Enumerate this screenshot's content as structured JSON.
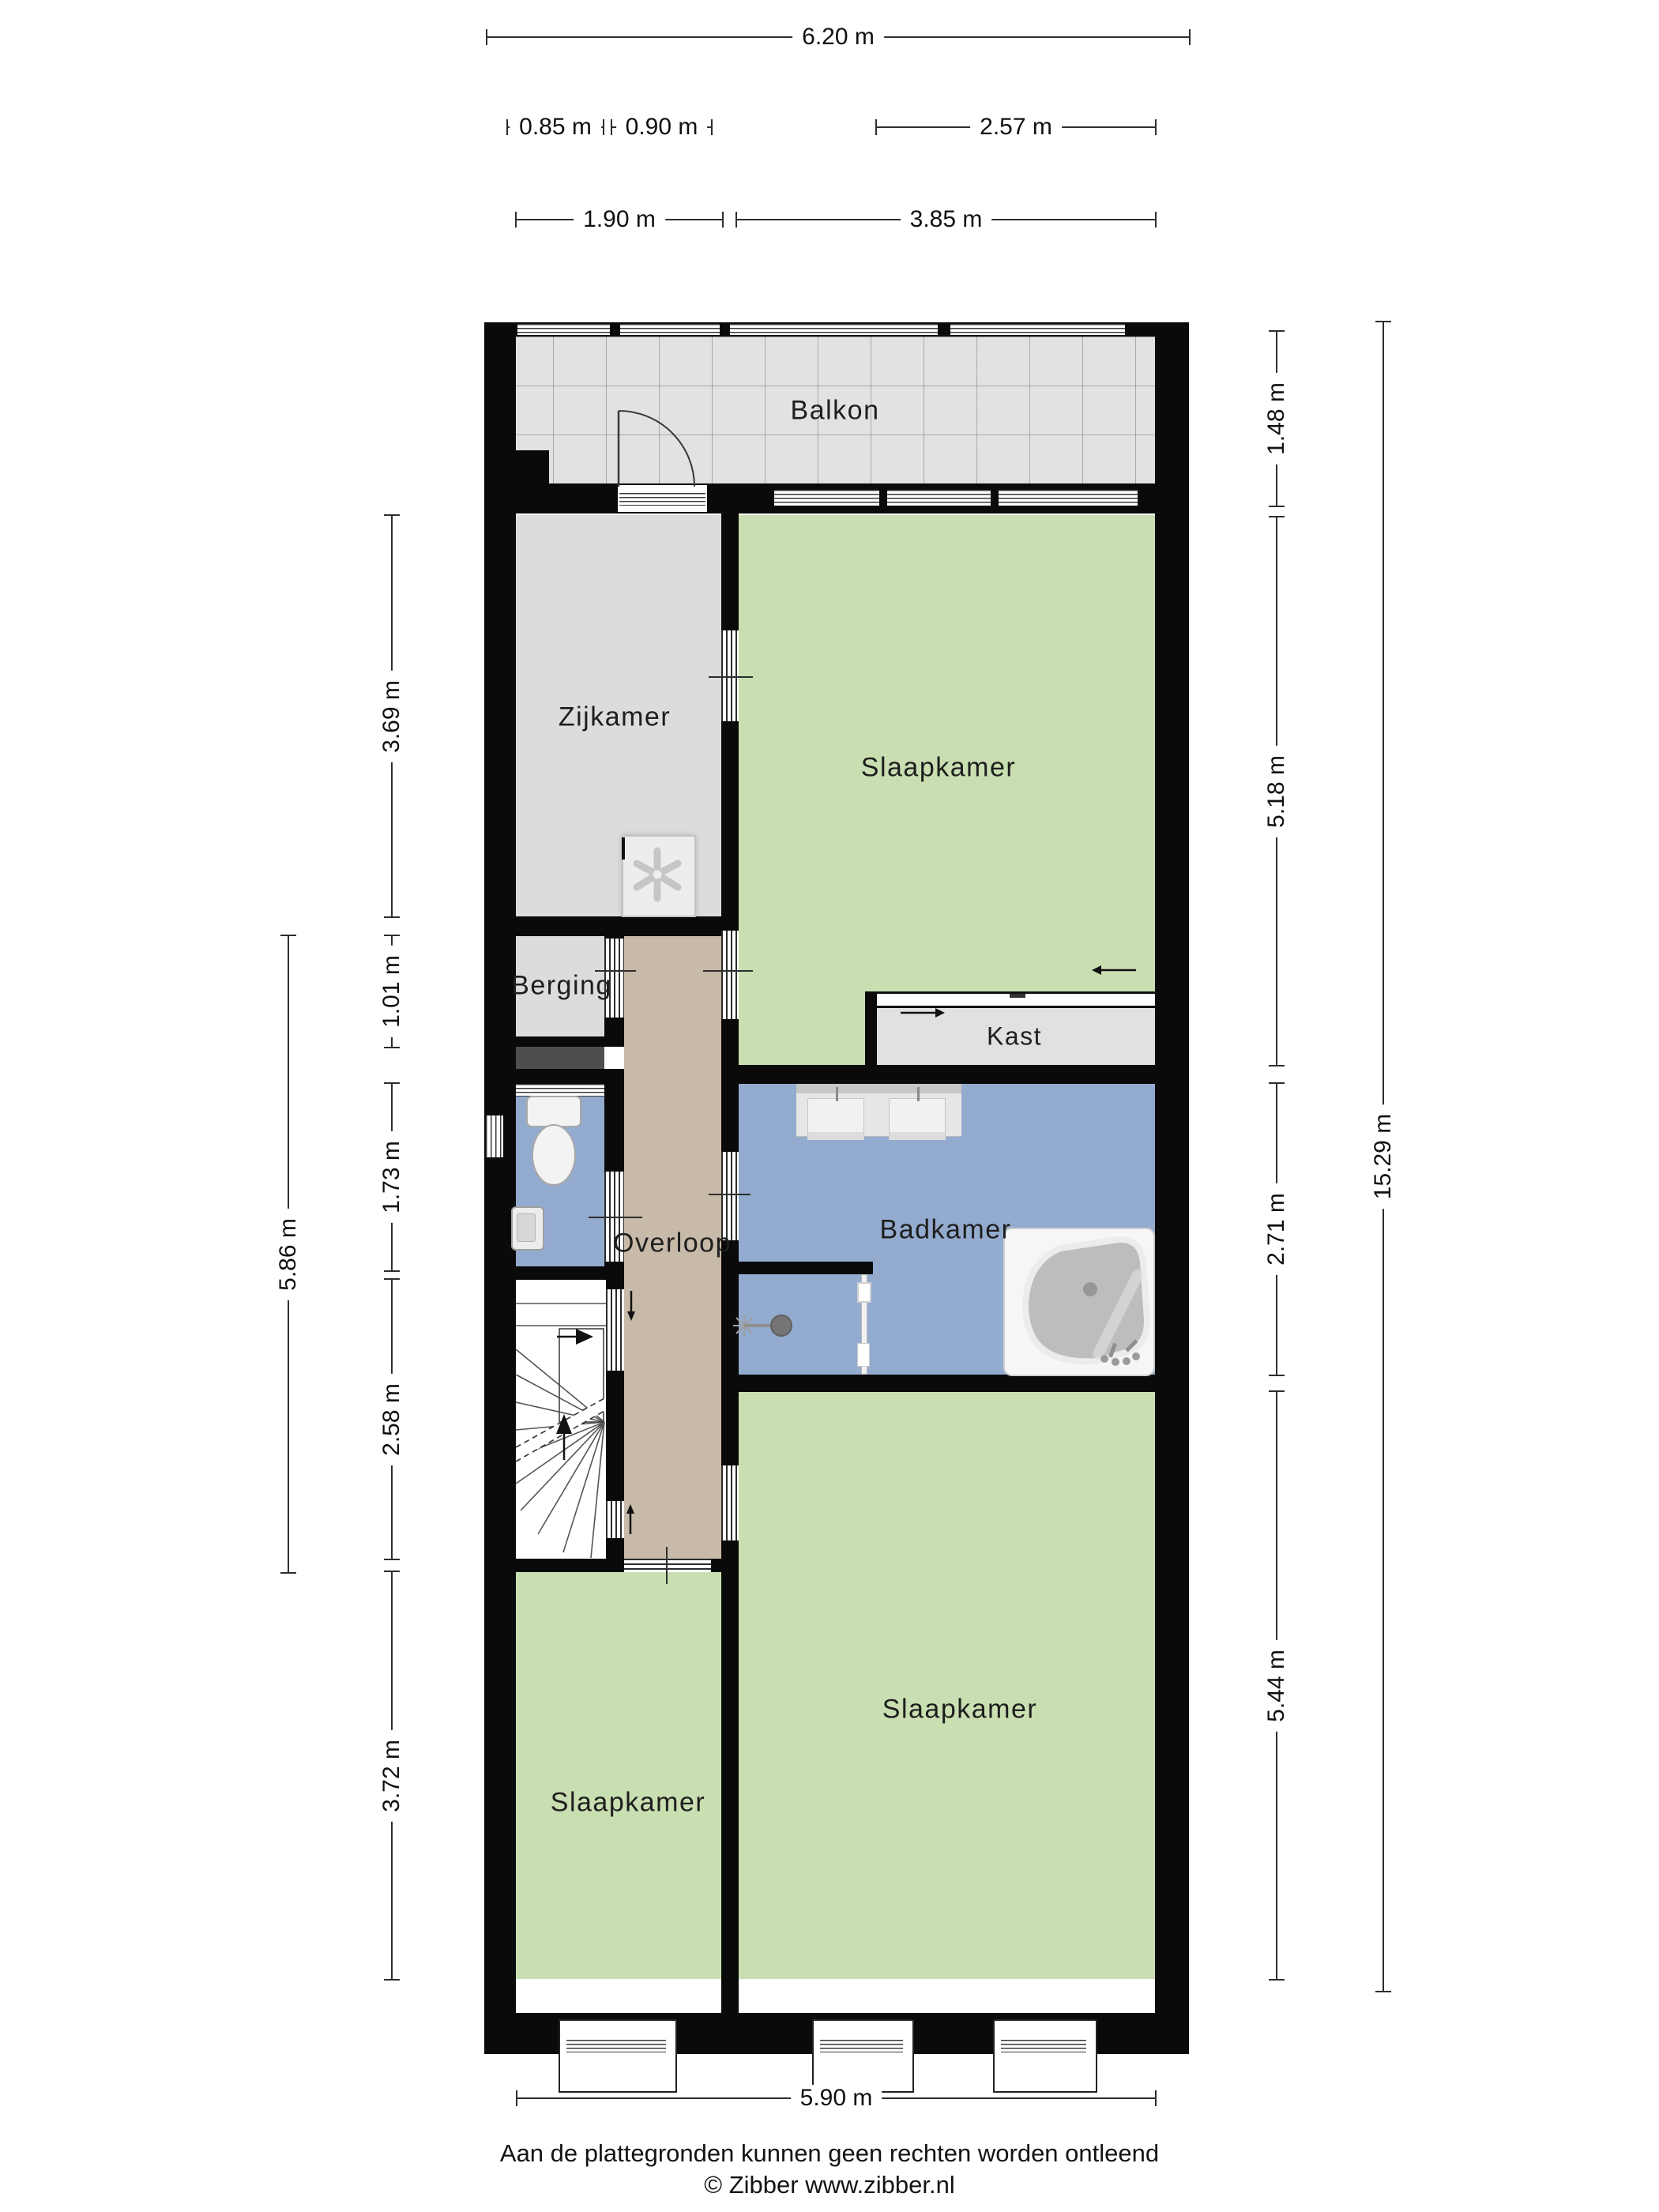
{
  "title": "Floor plan (plattegrond) - verdieping",
  "rooms": {
    "balkon": "Balkon",
    "zijkamer": "Zijkamer",
    "slaapkamer_top": "Slaapkamer",
    "berging": "Berging",
    "kast": "Kast",
    "overloop": "Overloop",
    "badkamer": "Badkamer",
    "slaapkamer_left": "Slaapkamer",
    "slaapkamer_right": "Slaapkamer"
  },
  "dims": {
    "top_total": "6.20 m",
    "top_085": "0.85 m",
    "top_090": "0.90 m",
    "top_257": "2.57 m",
    "top_190": "1.90 m",
    "top_385": "3.85 m",
    "left_586": "5.86 m",
    "left_369": "3.69 m",
    "left_101": "1.01 m",
    "left_173": "1.73 m",
    "left_258": "2.58 m",
    "left_372": "3.72 m",
    "right_148": "1.48 m",
    "right_518": "5.18 m",
    "right_271": "2.71 m",
    "right_544": "5.44 m",
    "right_total": "15.29 m",
    "bottom_total": "5.90 m"
  },
  "footer": {
    "disclaimer": "Aan de plattegronden kunnen geen rechten worden ontleend",
    "copyright": "© Zibber www.zibber.nl"
  },
  "colors": {
    "wall": "#0a0a0a",
    "floor_gray": "#dcdcdc",
    "green": "#c9dfb1",
    "blue": "#93abce",
    "tan": "#c8baa8",
    "tile": "#e2e2e2",
    "dark_strip": "#4e4e4e",
    "line": "#2e2e2e"
  }
}
